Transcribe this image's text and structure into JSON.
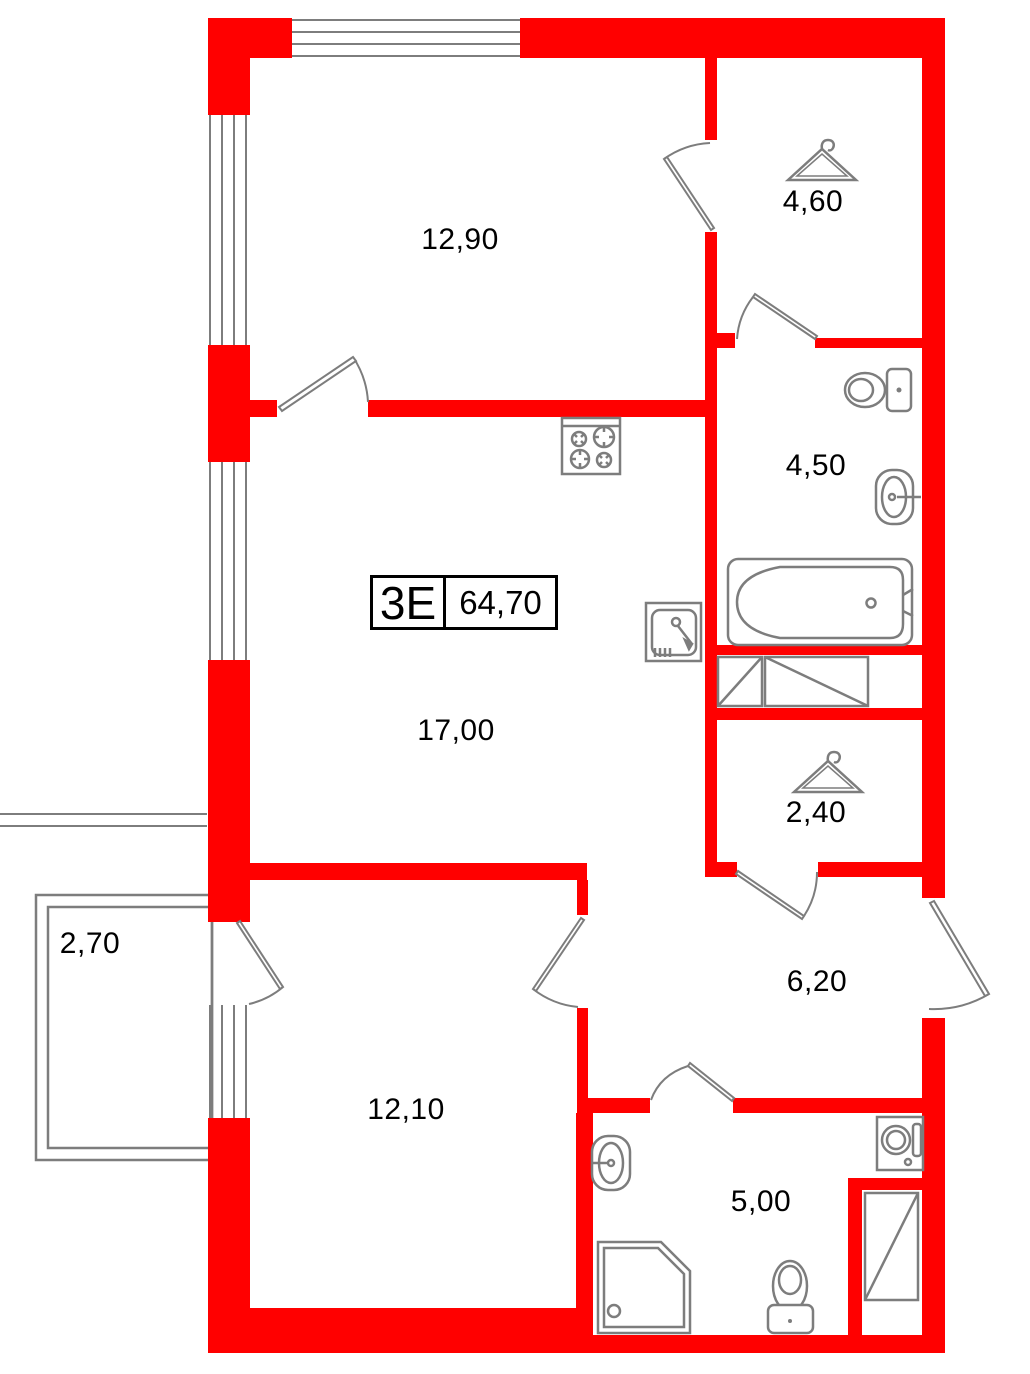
{
  "floorplan": {
    "unit_type_label": "3Е",
    "total_area_label": "64,70",
    "rooms": [
      {
        "id": "bedroom-top",
        "area": "12,90"
      },
      {
        "id": "wardrobe",
        "area": "4,60"
      },
      {
        "id": "bathroom-master",
        "area": "4,50"
      },
      {
        "id": "kitchen-living",
        "area": "17,00"
      },
      {
        "id": "closet",
        "area": "2,40"
      },
      {
        "id": "hallway",
        "area": "6,20"
      },
      {
        "id": "balcony",
        "area": "2,70"
      },
      {
        "id": "bedroom",
        "area": "12,10"
      },
      {
        "id": "bathroom",
        "area": "5,00"
      }
    ],
    "colors": {
      "wall": "#ff0000",
      "fixture_line": "#7d7d7d",
      "text": "#000000",
      "background": "#ffffff"
    },
    "icons": [
      "hanger-icon",
      "toilet-icon",
      "sink-icon",
      "bathtub-icon",
      "stove-icon",
      "kitchen-sink-icon",
      "shower-icon",
      "washing-machine-icon",
      "vent-shaft-icon",
      "door-swing-icon",
      "window-icon"
    ]
  }
}
